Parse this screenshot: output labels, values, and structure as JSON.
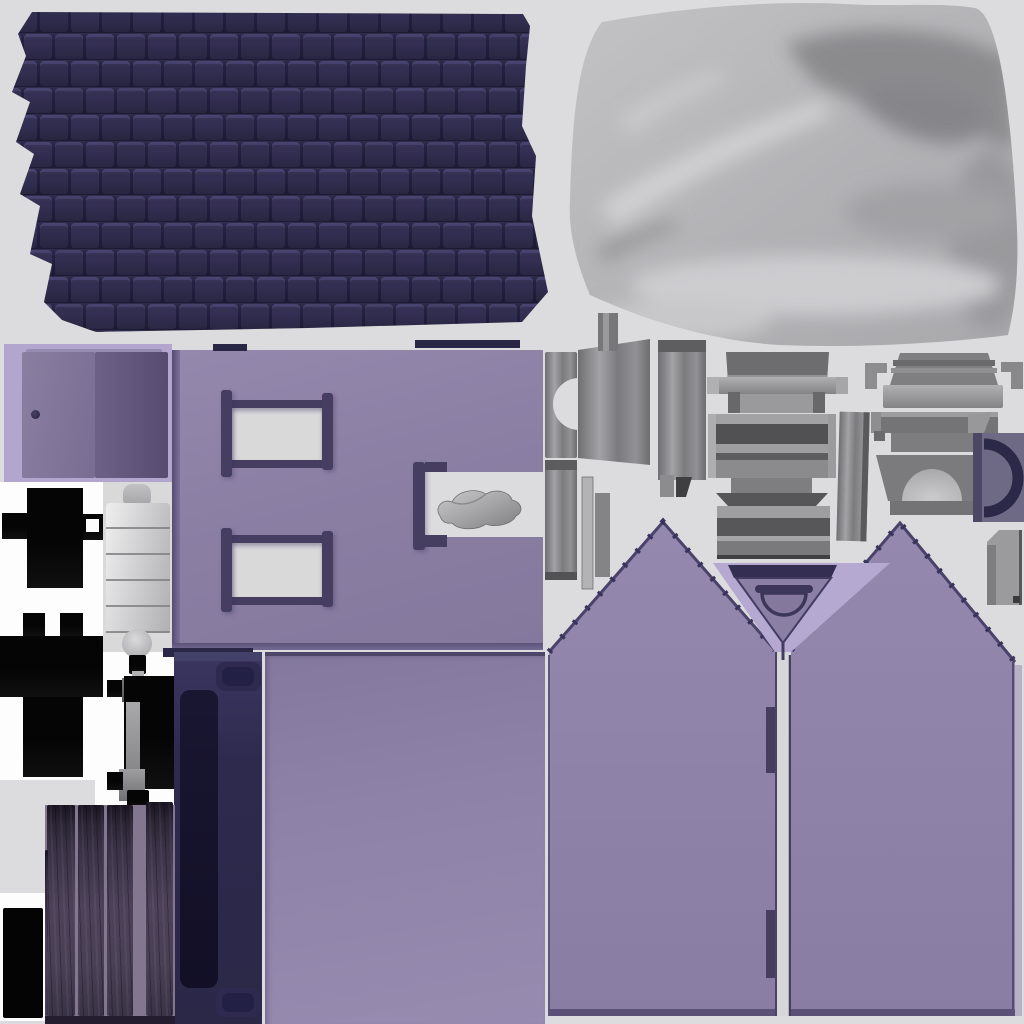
{
  "meta": {
    "title": "House model texture atlas",
    "type": "3d-texture-bake-sheet",
    "canvas": {
      "width": 1024,
      "height": 1024
    },
    "visible_text": "none"
  },
  "colors": {
    "bg": "#dcdbdd",
    "white": "#fdfdfd",
    "roof_gap": "#232040",
    "roof_tile": "#332f52",
    "roof_tile_light": "#423c6a",
    "fabric_base": "#b4b4b7",
    "fabric_dark": "#8b8b8e",
    "fabric_light": "#d5d5d7",
    "lavender": "#b2a5ce",
    "door_leaf": "#796d92",
    "wall_purple": "#8b7fa4",
    "frame": "#453e61",
    "glass": "#d9d9da",
    "black": "#050505",
    "metal_light": "#b3b3b6",
    "metal_mid": "#8a8a8d",
    "metal_dark": "#57575a",
    "navy": "#2e2a4f",
    "navy_inner": "#141127",
    "gable_purple": "#8e82a8",
    "gap_light": "#d7d6d9",
    "arc_navy": "#2c2848",
    "slate_square": "#6e6984",
    "wood_dark": "#3a3246",
    "woodgap": "#82778e"
  },
  "atlas_regions": [
    {
      "name": "roof-shingles",
      "bbox": [
        8,
        6,
        548,
        334
      ],
      "color": "#2b2745",
      "description": "staggered dark navy shingle grid, wavy edges"
    },
    {
      "name": "satin-fabric",
      "bbox": [
        560,
        0,
        464,
        350
      ],
      "color": "#b4b4b7",
      "description": "draped silver satin cloth with folds"
    },
    {
      "name": "door-with-frame",
      "bbox": [
        4,
        344,
        168,
        138
      ],
      "color": "#796d92",
      "description": "double door leaves on lavender frame, dark knob"
    },
    {
      "name": "wall-with-windows",
      "bbox": [
        172,
        350,
        371,
        300
      ],
      "color": "#8b7fa4",
      "description": "purple wall, two framed window cutouts"
    },
    {
      "name": "wall-notch-cloth",
      "bbox": [
        413,
        462,
        130,
        88
      ],
      "color": "#dcdcdd",
      "description": "notch with crumpled gray cloth"
    },
    {
      "name": "black-bracket-top",
      "bbox": [
        0,
        488,
        103,
        100
      ],
      "color": "#050505",
      "description": "cross-shaped black bracket with square hole"
    },
    {
      "name": "black-bracket-bottom",
      "bbox": [
        0,
        613,
        103,
        164
      ],
      "color": "#050505",
      "description": "black bracket with two ears"
    },
    {
      "name": "bedroll-cylinder",
      "bbox": [
        103,
        484,
        70,
        174
      ],
      "color": "#d2d2d4",
      "description": "segmented light gray roll with end caps"
    },
    {
      "name": "hinge-assembly",
      "bbox": [
        107,
        655,
        67,
        156
      ],
      "color": "#050505",
      "description": "black and steel hinge parts"
    },
    {
      "name": "clamp-piece",
      "bbox": [
        543,
        313,
        77,
        145
      ],
      "color": "#8a8a8d",
      "description": "gray clamp with semicircular notch and top tab"
    },
    {
      "name": "slat-panel-left",
      "bbox": [
        658,
        340,
        48,
        160
      ],
      "color": "#8a8a8d",
      "description": "striped vertical panel with feet"
    },
    {
      "name": "table-parts-center",
      "bbox": [
        707,
        352,
        141,
        210
      ],
      "color": "#8a8a8d",
      "description": "stacked table/bench bars and plinth"
    },
    {
      "name": "side-panel-mid",
      "bbox": [
        838,
        412,
        30,
        129
      ],
      "color": "#a6a6a9",
      "description": "vertical striped side panel"
    },
    {
      "name": "table-parts-right",
      "bbox": [
        865,
        348,
        157,
        107
      ],
      "color": "#8a8a8d",
      "description": "top slab, hooked bar, blocks"
    },
    {
      "name": "fireplace-arch",
      "bbox": [
        876,
        455,
        112,
        60
      ],
      "color": "#7b7b7e",
      "description": "trapezoid surround with light dome opening"
    },
    {
      "name": "arc-handle-square",
      "bbox": [
        973,
        433,
        51,
        89
      ],
      "color": "#6e6984",
      "description": "slate square with thick dark C arc"
    },
    {
      "name": "panel-bottom-right",
      "bbox": [
        987,
        525,
        35,
        80
      ],
      "color": "#9b9b9e",
      "description": "small notched gray panel"
    },
    {
      "name": "side-strips",
      "bbox": [
        545,
        460,
        63,
        130
      ],
      "color": "#a6a6a9",
      "description": "thin striped strips"
    },
    {
      "name": "gable-left",
      "bbox": [
        549,
        522,
        226,
        496
      ],
      "color": "#8e82a8",
      "description": "peaked gable wall, two hinge tabs on right edge"
    },
    {
      "name": "gable-right",
      "bbox": [
        791,
        523,
        231,
        495
      ],
      "color": "#8e82a8",
      "description": "peaked gable wall"
    },
    {
      "name": "gable-vent-triangle",
      "bbox": [
        713,
        563,
        177,
        95
      ],
      "color": "#b5a9d2",
      "description": "inverted lavender V with navy lintel and arch vent"
    },
    {
      "name": "shutter-panel",
      "bbox": [
        174,
        652,
        88,
        372
      ],
      "color": "#2e2a4f",
      "description": "navy panel, dark inset, two rounded tabs"
    },
    {
      "name": "purple-sheet-blank",
      "bbox": [
        265,
        652,
        280,
        372
      ],
      "color": "#8e82a8",
      "description": "plain purple rectangle"
    },
    {
      "name": "wood-planks",
      "bbox": [
        45,
        805,
        130,
        219
      ],
      "color": "#3a3246",
      "description": "four dark vertical planks on mauve gaps"
    },
    {
      "name": "small-black-rect",
      "bbox": [
        3,
        908,
        40,
        110
      ],
      "color": "#040404",
      "description": "solid black rectangle"
    }
  ]
}
